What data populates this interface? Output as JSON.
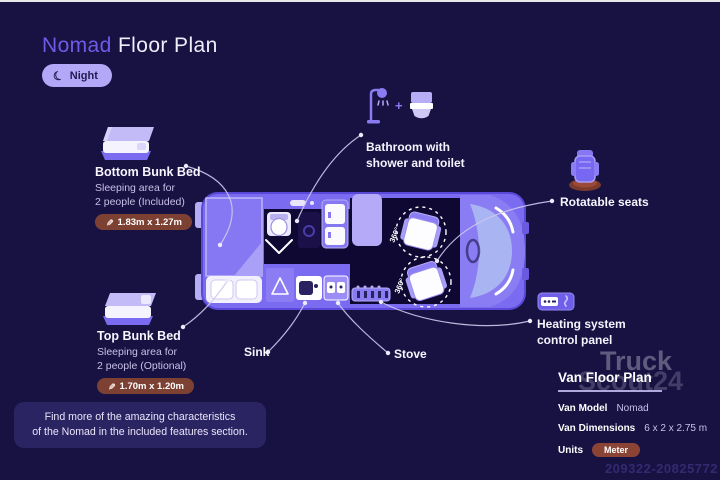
{
  "colors": {
    "background": "#181243",
    "accent_purple": "#7159e8",
    "night_pill_background": "#b3a8f8",
    "dimension_badge_background": "#7d4134",
    "unit_badge_background": "#8a4334",
    "van_body": "#7a6bf0",
    "van_interior_dark": "#0e0832",
    "furniture_light": "#b6adf6",
    "connector_line": "#cfc8ee"
  },
  "icons": {
    "moon_glyph": "☾",
    "pencil_glyph": "✎"
  },
  "header": {
    "title_accent": "Nomad",
    "title_rest": "Floor Plan",
    "night_toggle": {
      "label": "Night"
    }
  },
  "features": {
    "bottom_bunk": {
      "title": "Bottom Bunk Bed",
      "desc_line1": "Sleeping area for",
      "desc_line2": "2 people (Included)",
      "dimensions": "1.83m x 1.27m"
    },
    "top_bunk": {
      "title": "Top Bunk Bed",
      "desc_line1": "Sleeping area for",
      "desc_line2": "2 people (Optional)",
      "dimensions": "1.70m x 1.20m"
    },
    "bathroom": {
      "line1": "Bathroom with",
      "line2": "shower and toilet",
      "plus": "+"
    },
    "rotatable_seats": {
      "label": "Rotatable seats"
    },
    "heating": {
      "line1": "Heating system",
      "line2": "control panel"
    },
    "sink": {
      "label": "Sink"
    },
    "stove": {
      "label": "Stove"
    }
  },
  "floor_plan": {
    "rotation_label": "360°"
  },
  "spec_panel": {
    "title": "Van Floor Plan",
    "rows": [
      {
        "label": "Van Model",
        "value": "Nomad"
      },
      {
        "label": "Van Dimensions",
        "value": "6 x 2 x 2.75 m"
      },
      {
        "label": "Units",
        "value": "Meter"
      }
    ]
  },
  "footer_note": {
    "line1": "Find more of the amazing characteristics",
    "line2": "of the Nomad in the included features section."
  },
  "watermark": {
    "line1": "Truck",
    "line2": "Scout24",
    "ref_number": "209322-20825772"
  }
}
